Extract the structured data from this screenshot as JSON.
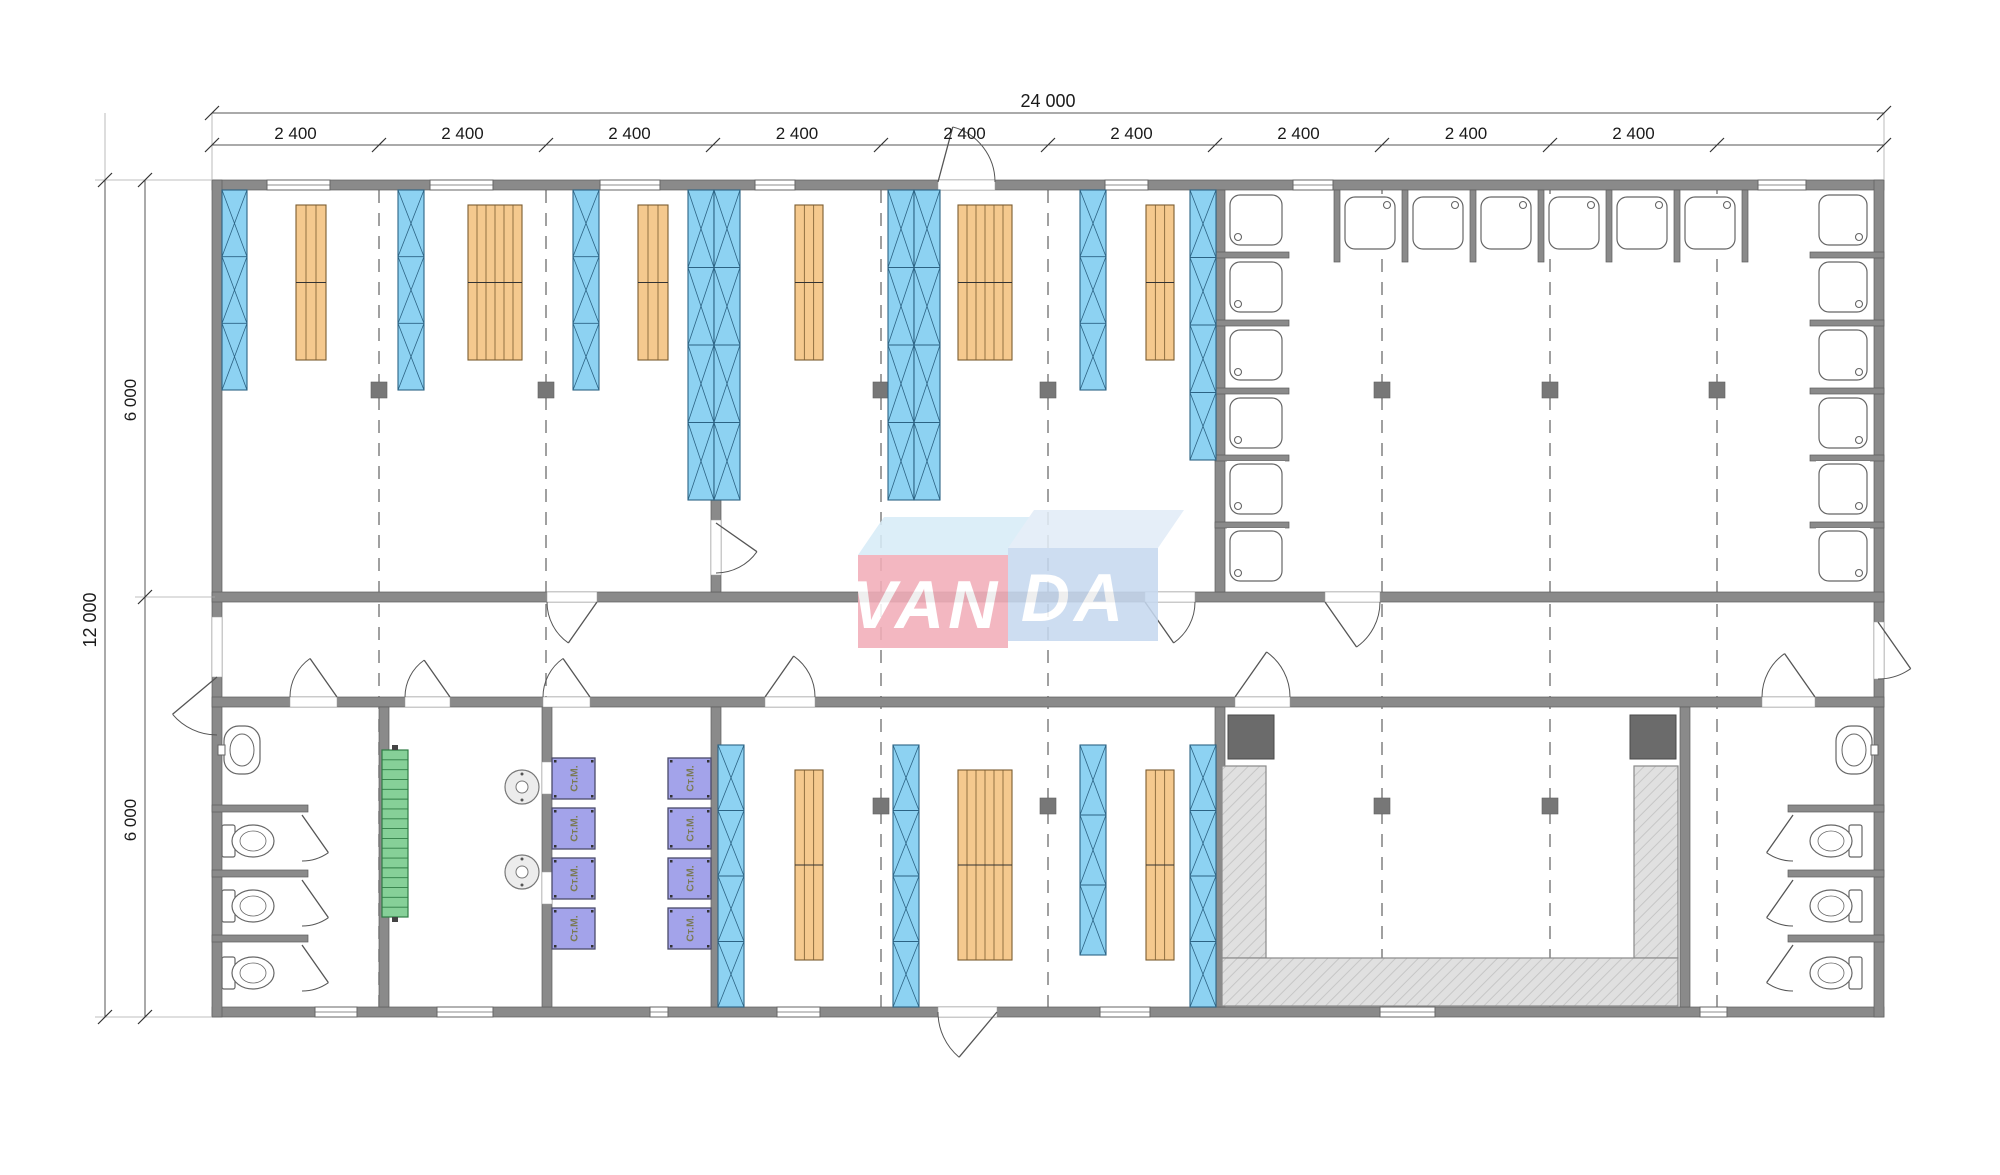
{
  "logo": {
    "left_text": "VAN",
    "right_text": "DA",
    "left_color": "#f2adb8",
    "right_color": "#c6d8ef",
    "left_bevel": "#d7ecf8",
    "right_bevel": "#e2ecf7",
    "text_color": "#ffffff"
  },
  "washing_machine_label": "Ст.М.",
  "colors": {
    "wall": "#8a8a8a",
    "wall_edge": "#5f5f5f",
    "bunk_fill": "#8dd2f2",
    "bunk_line": "#2c6384",
    "shelf_fill": "#f5c98e",
    "shelf_line": "#7a5c30",
    "stairs_fill": "#86d098",
    "stairs_line": "#2f7d45",
    "washer_fill": "#a3a3ea",
    "washer_line": "#4a4a6a",
    "washer_text": "#7a7a52",
    "bench_fill": "#e0e0e0",
    "bench_hatch": "#c6c6c6",
    "dark_box": "#6b6b6b",
    "fixture_line": "#666666",
    "dim_line": "#555555",
    "dim_text": "#1a1a1a",
    "dash_line": "#777777"
  },
  "dimensions": {
    "overall_width_label": "24 000",
    "module_label": "2 400",
    "module_label_count": 9,
    "overall_height_label": "12 000",
    "half_label": "6 000",
    "overall_line": {
      "y": 113,
      "x1": 212,
      "x2": 1884,
      "label_x": 1048,
      "label_y": 107
    },
    "module_line": {
      "y": 145,
      "ticks": [
        212,
        379,
        546,
        713,
        881,
        1048,
        1215,
        1382,
        1550,
        1717,
        1884
      ],
      "label_y": 139
    },
    "height_line": {
      "x": 105,
      "y1": 180,
      "y2": 1017,
      "label_x": 96,
      "label_y": 620
    },
    "half_line": {
      "x": 145,
      "ticks": [
        180,
        597,
        1017
      ],
      "label_x": 136,
      "label_ys": [
        400,
        820
      ]
    },
    "extensions": [
      [
        95,
        180,
        212,
        180
      ],
      [
        95,
        1017,
        212,
        1017
      ],
      [
        135,
        597,
        215,
        597
      ],
      [
        212,
        113,
        212,
        180
      ],
      [
        1884,
        113,
        1884,
        180
      ],
      [
        105,
        113,
        105,
        180
      ]
    ]
  },
  "floorplan": {
    "outline": {
      "x": 212,
      "y": 180,
      "w": 1682,
      "h": 847
    },
    "walls": [
      [
        212,
        180,
        1672,
        10
      ],
      [
        212,
        1007,
        1672,
        10
      ],
      [
        212,
        180,
        10,
        837
      ],
      [
        1874,
        180,
        10,
        837
      ],
      [
        212,
        592,
        1672,
        10
      ],
      [
        212,
        697,
        1672,
        10
      ],
      [
        711,
        190,
        10,
        402
      ],
      [
        1215,
        190,
        10,
        402
      ],
      [
        379,
        707,
        10,
        300
      ],
      [
        542,
        707,
        10,
        300
      ],
      [
        711,
        707,
        10,
        300
      ],
      [
        1215,
        707,
        10,
        300
      ],
      [
        1680,
        707,
        10,
        300
      ],
      [
        212,
        805,
        96,
        7
      ],
      [
        212,
        870,
        96,
        7
      ],
      [
        212,
        935,
        96,
        7
      ],
      [
        1788,
        805,
        96,
        7
      ],
      [
        1788,
        870,
        96,
        7
      ],
      [
        1788,
        935,
        96,
        7
      ],
      [
        1215,
        252,
        74,
        6
      ],
      [
        1215,
        320,
        74,
        6
      ],
      [
        1215,
        388,
        74,
        6
      ],
      [
        1215,
        455,
        74,
        6
      ],
      [
        1215,
        522,
        74,
        6
      ],
      [
        1334,
        190,
        6,
        72
      ],
      [
        1402,
        190,
        6,
        72
      ],
      [
        1470,
        190,
        6,
        72
      ],
      [
        1538,
        190,
        6,
        72
      ],
      [
        1606,
        190,
        6,
        72
      ],
      [
        1674,
        190,
        6,
        72
      ],
      [
        1742,
        190,
        6,
        72
      ],
      [
        1810,
        252,
        74,
        6
      ],
      [
        1810,
        320,
        74,
        6
      ],
      [
        1810,
        388,
        74,
        6
      ],
      [
        1810,
        455,
        74,
        6
      ],
      [
        1810,
        522,
        74,
        6
      ]
    ],
    "windows_top": [
      [
        267,
        180,
        63
      ],
      [
        430,
        180,
        63
      ],
      [
        600,
        180,
        60
      ],
      [
        755,
        180,
        40
      ],
      [
        1105,
        180,
        43
      ],
      [
        1293,
        180,
        40
      ],
      [
        1758,
        180,
        48
      ]
    ],
    "windows_bottom": [
      [
        315,
        1007,
        42
      ],
      [
        437,
        1007,
        56
      ],
      [
        650,
        1007,
        18
      ],
      [
        777,
        1007,
        43
      ],
      [
        1100,
        1007,
        50
      ],
      [
        1380,
        1007,
        55
      ],
      [
        1700,
        1007,
        27
      ]
    ],
    "dashes": {
      "xs": [
        379,
        546,
        881,
        1048,
        1382,
        1550,
        1717
      ],
      "y1": 190,
      "y2": 1007
    },
    "squares": [
      [
        371,
        382
      ],
      [
        538,
        382
      ],
      [
        873,
        382
      ],
      [
        1040,
        382
      ],
      [
        1374,
        382
      ],
      [
        1542,
        382
      ],
      [
        1709,
        382
      ],
      [
        873,
        798
      ],
      [
        1040,
        798
      ],
      [
        1374,
        798
      ],
      [
        1542,
        798
      ]
    ],
    "doors": [
      {
        "name": "exterior-door-top",
        "gap": [
          938,
          180,
          57,
          10
        ],
        "h": [
          938,
          182
        ],
        "r": 57,
        "a1": -75,
        "a2": 0
      },
      {
        "name": "exterior-door-bottom",
        "gap": [
          938,
          1007,
          59,
          10
        ],
        "h": [
          997,
          1012
        ],
        "r": 59,
        "a1": 130,
        "a2": 180
      },
      {
        "name": "exterior-door-left",
        "gap": [
          212,
          617,
          10,
          60
        ],
        "h": [
          217,
          677
        ],
        "r": 58,
        "a1": 140,
        "a2": 90
      },
      {
        "name": "exterior-door-right",
        "gap": [
          1874,
          622,
          10,
          57
        ],
        "h": [
          1878,
          622
        ],
        "r": 57,
        "a1": 55,
        "a2": 90
      },
      {
        "name": "door-dorm-room-1",
        "gap": [
          547,
          592,
          50,
          10
        ],
        "h": [
          597,
          602
        ],
        "r": 50,
        "a1": 125,
        "a2": 180
      },
      {
        "name": "door-dorm-room-2",
        "gap": [
          1145,
          592,
          50,
          10
        ],
        "h": [
          1145,
          602
        ],
        "r": 50,
        "a1": 55,
        "a2": 0
      },
      {
        "name": "door-washroom",
        "gap": [
          1325,
          592,
          55,
          10
        ],
        "h": [
          1325,
          602
        ],
        "r": 55,
        "a1": 55,
        "a2": 0
      },
      {
        "name": "door-toilet-left",
        "gap": [
          290,
          697,
          47,
          10
        ],
        "h": [
          337,
          697
        ],
        "r": 47,
        "a1": -125,
        "a2": -180
      },
      {
        "name": "door-utility-room",
        "gap": [
          405,
          697,
          45,
          10
        ],
        "h": [
          450,
          697
        ],
        "r": 45,
        "a1": -125,
        "a2": -180
      },
      {
        "name": "door-laundry-room",
        "gap": [
          543,
          697,
          47,
          10
        ],
        "h": [
          590,
          697
        ],
        "r": 47,
        "a1": -125,
        "a2": -180
      },
      {
        "name": "door-dorm-room-3",
        "gap": [
          765,
          697,
          50,
          10
        ],
        "h": [
          765,
          697
        ],
        "r": 50,
        "a1": -55,
        "a2": 0
      },
      {
        "name": "door-dining-room",
        "gap": [
          1235,
          697,
          55,
          10
        ],
        "h": [
          1235,
          697
        ],
        "r": 55,
        "a1": -55,
        "a2": 0
      },
      {
        "name": "door-toilet-right",
        "gap": [
          1762,
          697,
          53,
          10
        ],
        "h": [
          1815,
          697
        ],
        "r": 53,
        "a1": -125,
        "a2": -180
      },
      {
        "name": "door-between-dorms",
        "gap": [
          711,
          520,
          10,
          55
        ],
        "h": [
          716,
          523
        ],
        "r": 50,
        "a1": 35,
        "a2": 90
      },
      {
        "name": "toilet-stall-door",
        "h": [
          302,
          815
        ],
        "r": 46,
        "a1": 55,
        "a2": 90
      },
      {
        "name": "toilet-stall-door",
        "h": [
          302,
          880
        ],
        "r": 46,
        "a1": 55,
        "a2": 90
      },
      {
        "name": "toilet-stall-door",
        "h": [
          302,
          945
        ],
        "r": 46,
        "a1": 55,
        "a2": 90
      },
      {
        "name": "toilet-stall-door",
        "h": [
          1793,
          815
        ],
        "r": 46,
        "a1": 125,
        "a2": 90
      },
      {
        "name": "toilet-stall-door",
        "h": [
          1793,
          880
        ],
        "r": 46,
        "a1": 125,
        "a2": 90
      },
      {
        "name": "toilet-stall-door",
        "h": [
          1793,
          945
        ],
        "r": 46,
        "a1": 125,
        "a2": 90
      },
      {
        "name": "laundry-side-door",
        "gap": [
          542,
          762,
          10,
          32
        ]
      },
      {
        "name": "laundry-side-door",
        "gap": [
          542,
          872,
          10,
          32
        ]
      }
    ],
    "bunks": [
      [
        222,
        190,
        25,
        200,
        3
      ],
      [
        398,
        190,
        26,
        200,
        3
      ],
      [
        573,
        190,
        26,
        200,
        3
      ],
      [
        688,
        190,
        26,
        310,
        4
      ],
      [
        714,
        190,
        26,
        310,
        4
      ],
      [
        888,
        190,
        26,
        310,
        4
      ],
      [
        914,
        190,
        26,
        310,
        4
      ],
      [
        1080,
        190,
        26,
        200,
        3
      ],
      [
        1190,
        190,
        26,
        270,
        4
      ],
      [
        718,
        745,
        26,
        262,
        4
      ],
      [
        893,
        745,
        26,
        262,
        4
      ],
      [
        1080,
        745,
        26,
        210,
        3
      ],
      [
        1190,
        745,
        26,
        262,
        4
      ]
    ],
    "shelves": [
      [
        296,
        205,
        30,
        155,
        3
      ],
      [
        468,
        205,
        54,
        155,
        6
      ],
      [
        638,
        205,
        30,
        155,
        3
      ],
      [
        795,
        205,
        28,
        155,
        3
      ],
      [
        958,
        205,
        54,
        155,
        6
      ],
      [
        1146,
        205,
        28,
        155,
        3
      ],
      [
        795,
        770,
        28,
        190,
        3
      ],
      [
        958,
        770,
        54,
        190,
        6
      ],
      [
        1146,
        770,
        28,
        190,
        3
      ]
    ],
    "shower_stalls": {
      "left_col": {
        "x": 1227,
        "w": 58,
        "ys": [
          192,
          259,
          327,
          395,
          461,
          528
        ],
        "h": 56,
        "drain": "bl"
      },
      "top_row": {
        "y": 194,
        "h": 58,
        "xs": [
          1342,
          1410,
          1478,
          1546,
          1614,
          1682
        ],
        "w": 56,
        "drain": "tr"
      },
      "right_col": {
        "x": 1816,
        "w": 54,
        "ys": [
          192,
          259,
          327,
          395,
          461,
          528
        ],
        "h": 56,
        "drain": "br"
      }
    },
    "washers": {
      "cols": [
        552,
        668
      ],
      "rows": [
        758,
        808,
        858,
        908
      ],
      "w": 43,
      "h": 41
    },
    "stairs": {
      "x": 382,
      "y": 750,
      "w": 26,
      "h": 167,
      "steps": 17
    },
    "boilers": {
      "centers": [
        [
          522,
          787
        ],
        [
          522,
          872
        ]
      ],
      "r": 17
    },
    "toilets": {
      "left": {
        "tank_x": 222,
        "bowl_cx": 253,
        "cys": [
          841,
          906,
          973
        ]
      },
      "right": {
        "tank_x": 1849,
        "bowl_cx": 1831,
        "cys": [
          841,
          906,
          973
        ]
      }
    },
    "sinks": [
      {
        "x": 224,
        "y": 726,
        "w": 36,
        "h": 48,
        "side": "left"
      },
      {
        "x": 1836,
        "y": 726,
        "w": 36,
        "h": 48,
        "side": "right"
      }
    ],
    "bench_u": [
      [
        1222,
        766,
        44,
        192
      ],
      [
        1634,
        766,
        44,
        192
      ],
      [
        1222,
        958,
        456,
        48
      ]
    ],
    "dark_boxes": [
      [
        1228,
        715,
        46,
        44
      ],
      [
        1630,
        715,
        46,
        44
      ]
    ],
    "logo_geo": {
      "pink": [
        858,
        555,
        150,
        93
      ],
      "blue": [
        1008,
        548,
        150,
        93
      ],
      "pink_bevel": "858,555 1008,555 1034,517 884,517",
      "blue_bevel": "1008,548 1158,548 1184,510 1034,510",
      "van_pos": [
        926,
        628
      ],
      "da_pos": [
        1074,
        621
      ]
    }
  }
}
